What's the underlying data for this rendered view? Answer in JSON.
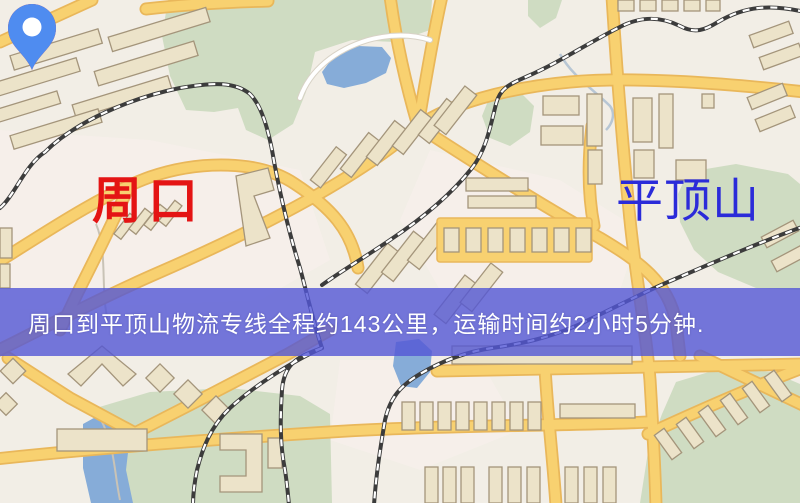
{
  "map": {
    "markers": {
      "origin": {
        "label": "周口",
        "pin_color": "#f21414",
        "label_color": "#e41414"
      },
      "destination": {
        "label": "平顶山",
        "pin_color": "#4f8cf0",
        "label_color": "#2b2bd9"
      }
    },
    "banner": {
      "text": "周口到平顶山物流专线全程约143公里，运输时间约2小时5分钟.",
      "background": "#5356d6",
      "text_color": "#ffffff",
      "distance_km": "143",
      "duration": "2小时5分钟"
    },
    "palette": {
      "background": "#f2eee6",
      "road": "#f8d170",
      "road_casing": "#e9b75a",
      "building": "#ece3c9",
      "building_outline": "#a4957b",
      "park_green": "#cfdcc2",
      "water_blue": "#86acd8",
      "railway": "#3c3c3c"
    }
  }
}
